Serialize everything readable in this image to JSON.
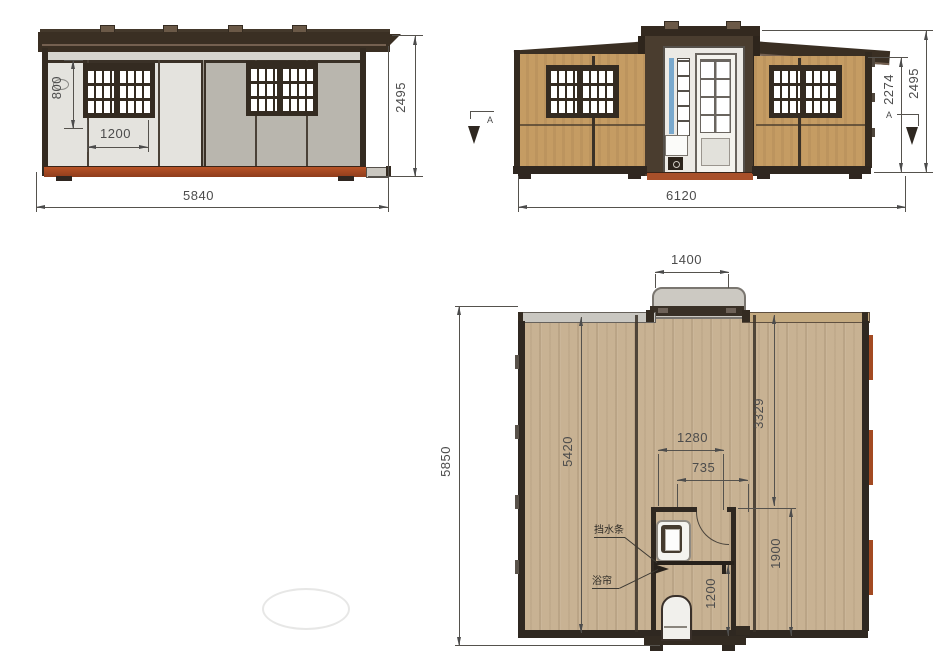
{
  "front_elevation": {
    "dim_window_height": "800",
    "dim_window_width": "1200",
    "dim_total_width": "5840",
    "dim_total_height": "2495"
  },
  "side_elevation": {
    "dim_total_width": "6120",
    "dim_wall_height": "2274",
    "dim_total_height": "2495",
    "section_marker": "A"
  },
  "floor_plan": {
    "dim_entry_width": "1400",
    "dim_total_length": "5850",
    "dim_main_room_length": "5420",
    "dim_right_room_depth": "3329",
    "dim_bathroom_width": "1280",
    "dim_door_opening": "735",
    "dim_bathroom_length": "1900",
    "dim_shower_depth": "1200",
    "label_water_strip": "挡水条",
    "label_shower_curtain": "浴帘"
  },
  "colors": {
    "frame_dark": "#342b21",
    "panel_light": "#e4e3de",
    "panel_gray": "#b9b6ae",
    "wall_tan": "#c59c63",
    "base_rust": "#a34a22",
    "floor_wood": "#c8b293",
    "dim_line": "#55524d"
  }
}
